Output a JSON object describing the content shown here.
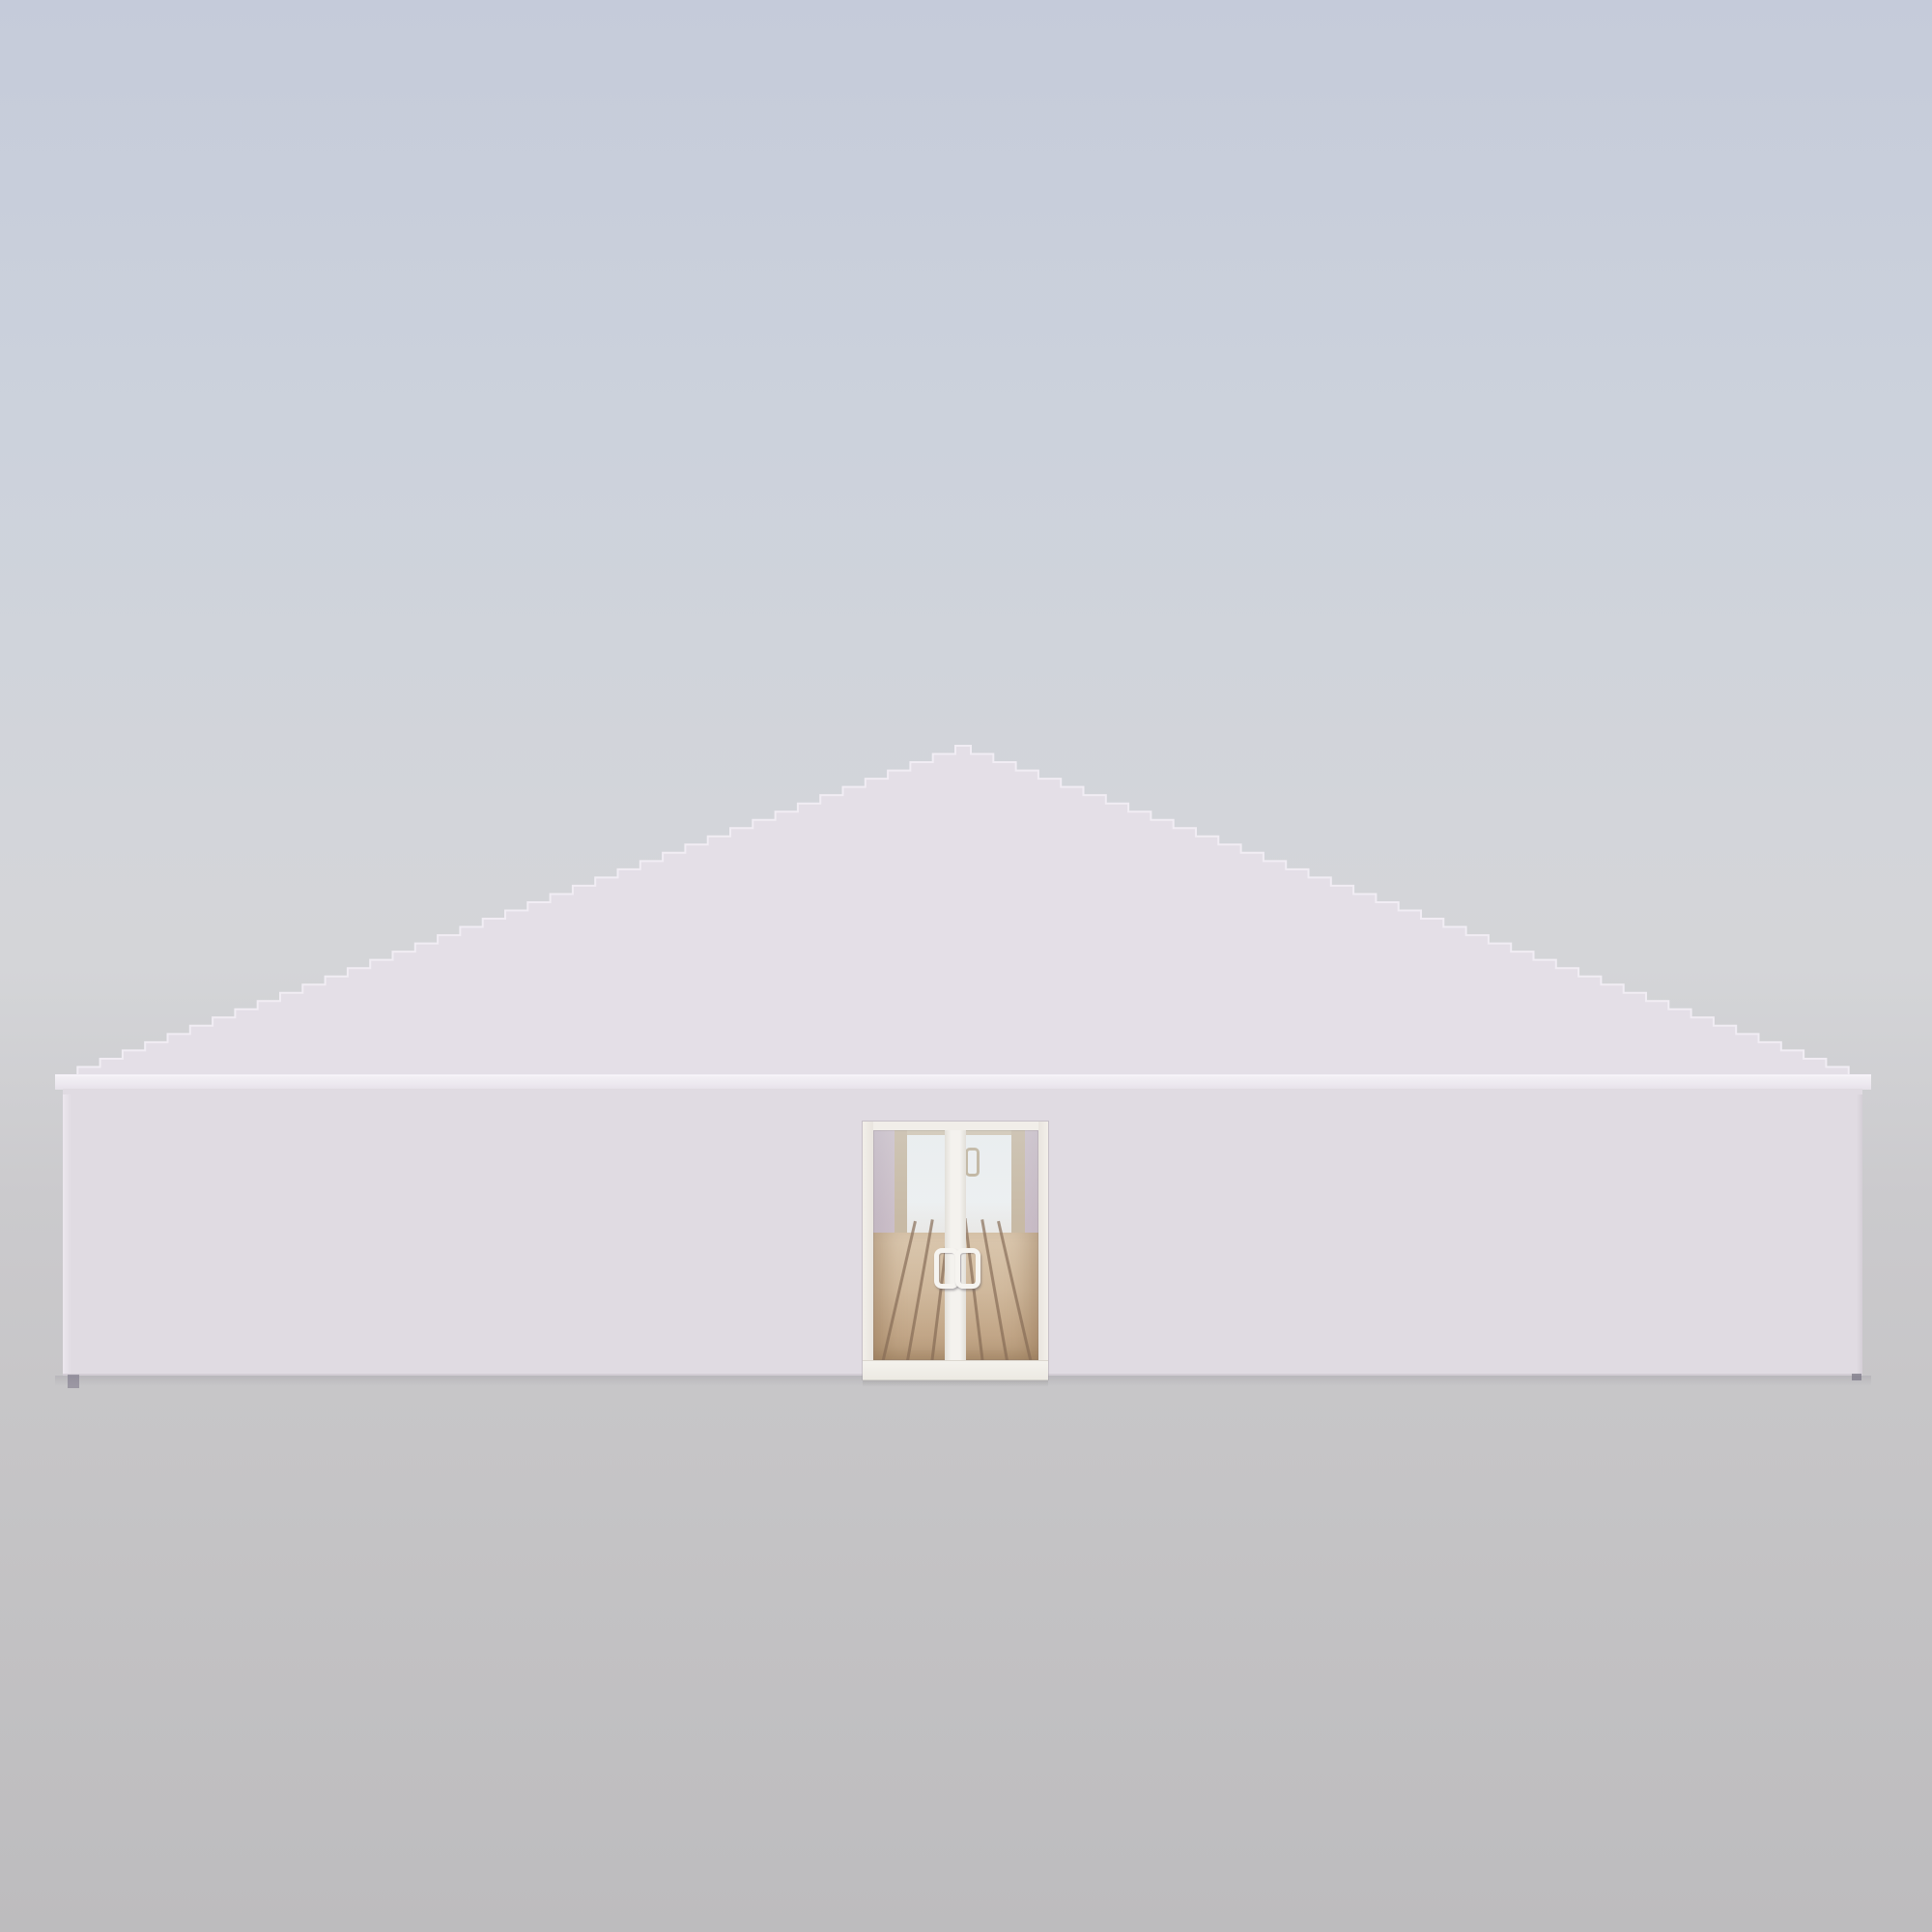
{
  "scene": {
    "description": "3D product render: white marquee event tent, front elevation, pyramid roof, glass double entrance door, wooden plank floor visible inside",
    "objects": [
      "pyramid-roof",
      "eave-fascia",
      "front-wall",
      "glass-double-door",
      "door-mullion",
      "door-pull-handles",
      "interior-back-door",
      "wooden-plank-floor",
      "ground-plane"
    ]
  },
  "colors": {
    "background_top": "#c5cbda",
    "background_mid": "#d4d5d8",
    "background_bottom": "#bdbcbe",
    "roof": "#e4dfe7",
    "roof_edge_highlight": "#f1edf4",
    "fascia": "#eee9f0",
    "eave_shadow": "#a7a2ba",
    "wall": "#e0dbe2",
    "door_frame": "#f0ede8",
    "door_sill": "#f1efe9",
    "mullion": "#f4f2ee",
    "handle": "#f6f4f0",
    "glass_tint": "#e6edf0",
    "interior_wall": "#c7b7c2",
    "interior_trim": "#c2b097",
    "interior_back_door": "#eef0f1",
    "interior_back_door_handle": "#b7a78c",
    "floor_light": "#d8c0a2",
    "floor_dark": "#b3946f",
    "plank_line": "#7d5f45",
    "ground": "#bdbcbe"
  }
}
